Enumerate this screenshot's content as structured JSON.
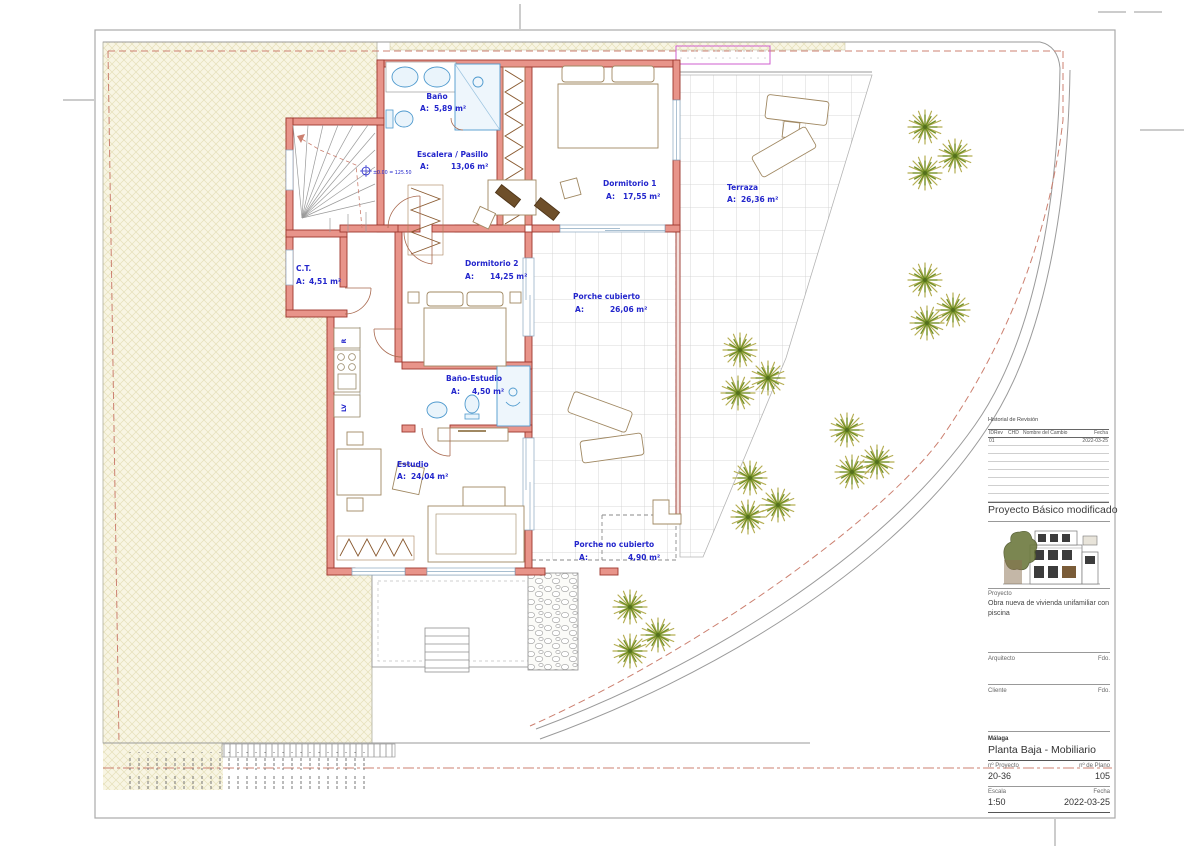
{
  "plan": {
    "area_prefix": "A:",
    "level_marker": "±0.00 = 125.50",
    "kitchen_labels": {
      "fridge": "R",
      "dishwasher": "LV"
    },
    "rooms": [
      {
        "name": "Baño",
        "area": "5,89 m²"
      },
      {
        "name": "Escalera / Pasillo",
        "area": "13,06 m²"
      },
      {
        "name": "Dormitorio 1",
        "area": "17,55 m²"
      },
      {
        "name": "Terraza",
        "area": "26,36 m²"
      },
      {
        "name": "C.T.",
        "area": "4,51 m²"
      },
      {
        "name": "Dormitorio 2",
        "area": "14,25 m²"
      },
      {
        "name": "Porche cubierto",
        "area": "26,06 m²"
      },
      {
        "name": "Baño-Estudio",
        "area": "4,50 m²"
      },
      {
        "name": "Estudio",
        "area": "24,04 m²"
      },
      {
        "name": "Porche no cubierto",
        "area": "4,90 m²"
      }
    ]
  },
  "site": {
    "trees": [
      {
        "x": 925,
        "y": 127
      },
      {
        "x": 955,
        "y": 156
      },
      {
        "x": 925,
        "y": 173
      },
      {
        "x": 925,
        "y": 280
      },
      {
        "x": 953,
        "y": 310
      },
      {
        "x": 927,
        "y": 323
      },
      {
        "x": 740,
        "y": 350
      },
      {
        "x": 768,
        "y": 378
      },
      {
        "x": 738,
        "y": 393
      },
      {
        "x": 847,
        "y": 430
      },
      {
        "x": 877,
        "y": 462
      },
      {
        "x": 852,
        "y": 472
      },
      {
        "x": 750,
        "y": 478
      },
      {
        "x": 778,
        "y": 505
      },
      {
        "x": 748,
        "y": 517
      },
      {
        "x": 630,
        "y": 607
      },
      {
        "x": 658,
        "y": 635
      },
      {
        "x": 630,
        "y": 651
      }
    ]
  },
  "titleblock": {
    "revision": {
      "title": "Historial de Revisión",
      "columns": [
        "IDRev",
        "CHD",
        "Nombre del Cambio",
        "Fecha"
      ],
      "rows": [
        {
          "idrev": "01",
          "chd": "",
          "nombre": "",
          "fecha": "2022-03-25"
        }
      ]
    },
    "project_title": "Proyecto Básico modificado",
    "project_label": "Proyecto",
    "project_description_line1": "Obra nueva de vivienda unifamiliar con",
    "project_description_line2": "piscina",
    "architect_label": "Arquitecto",
    "client_label": "Cliente",
    "fdo_label": "Fdo.",
    "city": "Málaga",
    "plan_title": "Planta Baja - Mobiliario",
    "project_no_label": "nº Proyecto",
    "project_no": "20-36",
    "plan_no_label": "nº de Plano",
    "plan_no": "105",
    "scale_label": "Escala",
    "scale": "1:50",
    "date_label": "Fecha",
    "date": "2022-03-25"
  },
  "colors": {
    "label_blue": "#2326cc",
    "wall_fill": "#e8948a",
    "wall_stroke": "#9e372e",
    "fixture_blue": "#4f9ace",
    "garden_fill": "#f8f5e3",
    "setback_red": "#cc8070",
    "boundary_magenta": "#cf5fcf",
    "tree_green": "#6f8f26"
  }
}
